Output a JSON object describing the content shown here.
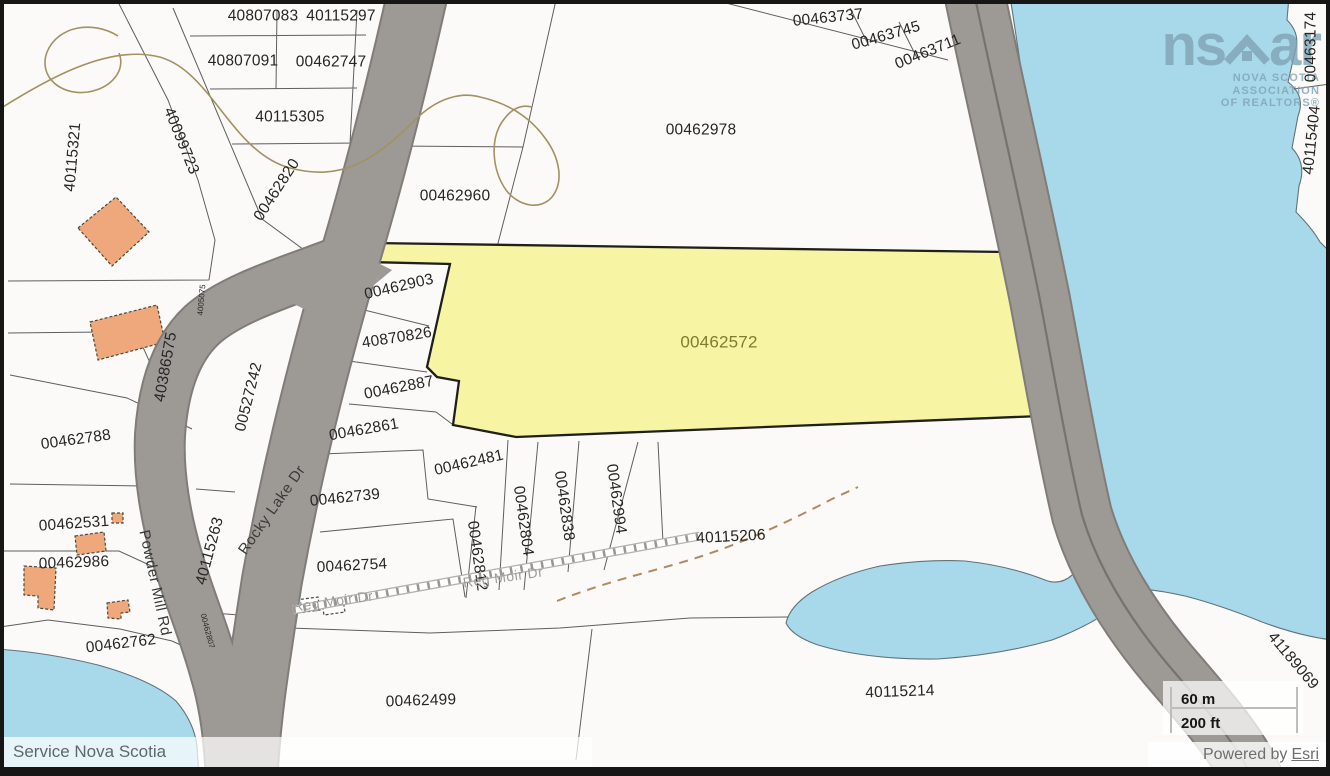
{
  "map": {
    "subject_parcel_id": "00462572",
    "labels": [
      {
        "t": "40807083",
        "x": 263,
        "y": 16,
        "r": 0
      },
      {
        "t": "40115297",
        "x": 341,
        "y": 16,
        "r": 0
      },
      {
        "t": "40807091",
        "x": 243,
        "y": 61,
        "r": 0
      },
      {
        "t": "00462747",
        "x": 331,
        "y": 62,
        "r": 0
      },
      {
        "t": "40115305",
        "x": 290,
        "y": 117,
        "r": 0
      },
      {
        "t": "00462820",
        "x": 277,
        "y": 190,
        "r": -57
      },
      {
        "t": "40099723",
        "x": 181,
        "y": 141,
        "r": 68
      },
      {
        "t": "40115321",
        "x": 73,
        "y": 157,
        "r": -85
      },
      {
        "t": "00462960",
        "x": 455,
        "y": 196,
        "r": 0
      },
      {
        "t": "00462978",
        "x": 701,
        "y": 130,
        "r": 0
      },
      {
        "t": "00463737",
        "x": 828,
        "y": 18,
        "r": -6
      },
      {
        "t": "00463745",
        "x": 886,
        "y": 36,
        "r": -16
      },
      {
        "t": "00463711",
        "x": 928,
        "y": 52,
        "r": -22
      },
      {
        "t": "00463174",
        "x": 1311,
        "y": 47,
        "r": -90
      },
      {
        "t": "40115404",
        "x": 1312,
        "y": 140,
        "r": -84
      },
      {
        "t": "00462572",
        "x": 719,
        "y": 342,
        "r": 0,
        "c": "subject"
      },
      {
        "t": "00462903",
        "x": 399,
        "y": 287,
        "r": -13
      },
      {
        "t": "40870826",
        "x": 397,
        "y": 338,
        "r": -9
      },
      {
        "t": "00462887",
        "x": 399,
        "y": 388,
        "r": -11
      },
      {
        "t": "00462861",
        "x": 364,
        "y": 430,
        "r": -10
      },
      {
        "t": "00462481",
        "x": 469,
        "y": 463,
        "r": -13
      },
      {
        "t": "00462739",
        "x": 345,
        "y": 498,
        "r": -6
      },
      {
        "t": "00462754",
        "x": 352,
        "y": 566,
        "r": -3
      },
      {
        "t": "00462812",
        "x": 477,
        "y": 556,
        "r": 82
      },
      {
        "t": "00462804",
        "x": 523,
        "y": 521,
        "r": 82
      },
      {
        "t": "00462838",
        "x": 564,
        "y": 506,
        "r": 82
      },
      {
        "t": "00462994",
        "x": 616,
        "y": 499,
        "r": 82
      },
      {
        "t": "40115206",
        "x": 731,
        "y": 537,
        "r": -3
      },
      {
        "t": "40115214",
        "x": 900,
        "y": 692,
        "r": -2
      },
      {
        "t": "00462499",
        "x": 421,
        "y": 701,
        "r": -2
      },
      {
        "t": "00462762",
        "x": 121,
        "y": 644,
        "r": -7
      },
      {
        "t": "00462986",
        "x": 74,
        "y": 563,
        "r": -2
      },
      {
        "t": "00462531",
        "x": 74,
        "y": 524,
        "r": -4
      },
      {
        "t": "00462788",
        "x": 76,
        "y": 440,
        "r": -8
      },
      {
        "t": "40386575",
        "x": 166,
        "y": 367,
        "r": -80
      },
      {
        "t": "00527242",
        "x": 249,
        "y": 397,
        "r": -76
      },
      {
        "t": "40115263",
        "x": 210,
        "y": 551,
        "r": -75
      },
      {
        "t": "41189069",
        "x": 1293,
        "y": 661,
        "r": 50
      },
      {
        "t": "4005075",
        "x": 202,
        "y": 300,
        "r": -85,
        "c": "tiny"
      },
      {
        "t": "00462807",
        "x": 207,
        "y": 631,
        "r": 75,
        "c": "tiny"
      },
      {
        "t": "Powder Mill Rd",
        "x": 155,
        "y": 583,
        "r": 78,
        "c": "road"
      },
      {
        "t": "Rocky Lake Dr",
        "x": 272,
        "y": 510,
        "r": -55,
        "c": "road"
      },
      {
        "t": "Reg Moir Dr",
        "x": 333,
        "y": 601,
        "r": -8,
        "c": "road-gray"
      },
      {
        "t": "Reg Moir Dr",
        "x": 503,
        "y": 577,
        "r": -8,
        "c": "road-gray"
      }
    ]
  },
  "logo": {
    "prefix": "ns",
    "suffix": "ar",
    "line1": "NOVA SCOTIA ASSOCIATION",
    "line2": "OF REALTORS®"
  },
  "scalebar": {
    "metric": "60 m",
    "imperial": "200 ft"
  },
  "attribution": {
    "left": "Service Nova Scotia",
    "powered_prefix": "Powered by",
    "powered_link": "Esri"
  },
  "colors": {
    "subject_fill": "#f7f5a3",
    "subject_label": "#7d7d2e",
    "water": "#a8d9ea",
    "road": "#9d9a96",
    "building": "#eea87c",
    "contour": "#a29162",
    "logo": "#7fa3b5"
  }
}
